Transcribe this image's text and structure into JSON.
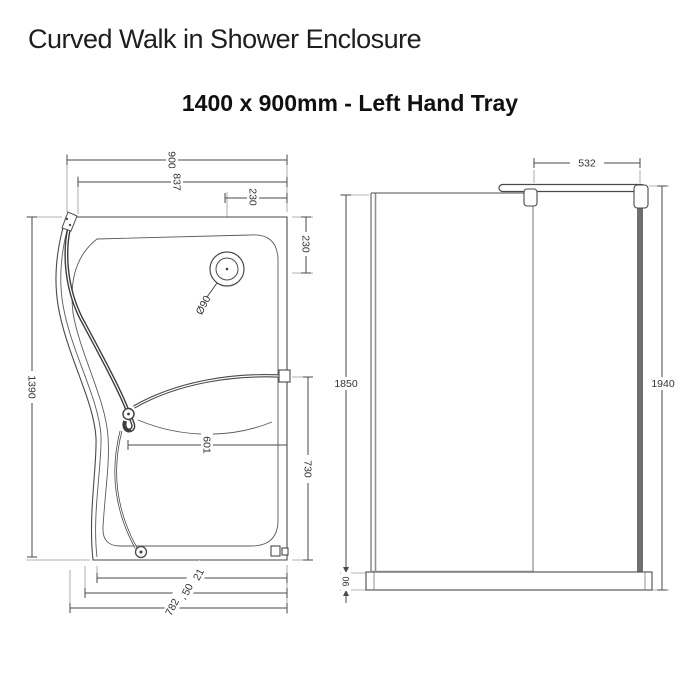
{
  "page": {
    "title": "Curved Walk in Shower Enclosure",
    "subtitle": "1400 x 900mm - Left Hand Tray"
  },
  "colors": {
    "background": "#ffffff",
    "line": "#4a4a4a",
    "glass_line": "#3d3d3d",
    "light_line": "#8f8f8f",
    "wall_profile": "#6f6f6f",
    "title_text": "#1e1e1e",
    "dim_text": "#333333"
  },
  "plan_view": {
    "dims": {
      "overall_width": "900",
      "rim_width": "837",
      "drain_to_wall": "230",
      "drain_from_top": "230",
      "drain_diameter": "Ø90",
      "bar_reach": "601",
      "opening_depth": "730",
      "overall_depth": "1390",
      "bottom_inner": "721",
      "bottom_mid": "750",
      "bottom_outer": "782"
    }
  },
  "side_view": {
    "dims": {
      "bar_length": "532",
      "panel_height": "1850",
      "overall_height": "1940",
      "tray_height": "90"
    }
  }
}
